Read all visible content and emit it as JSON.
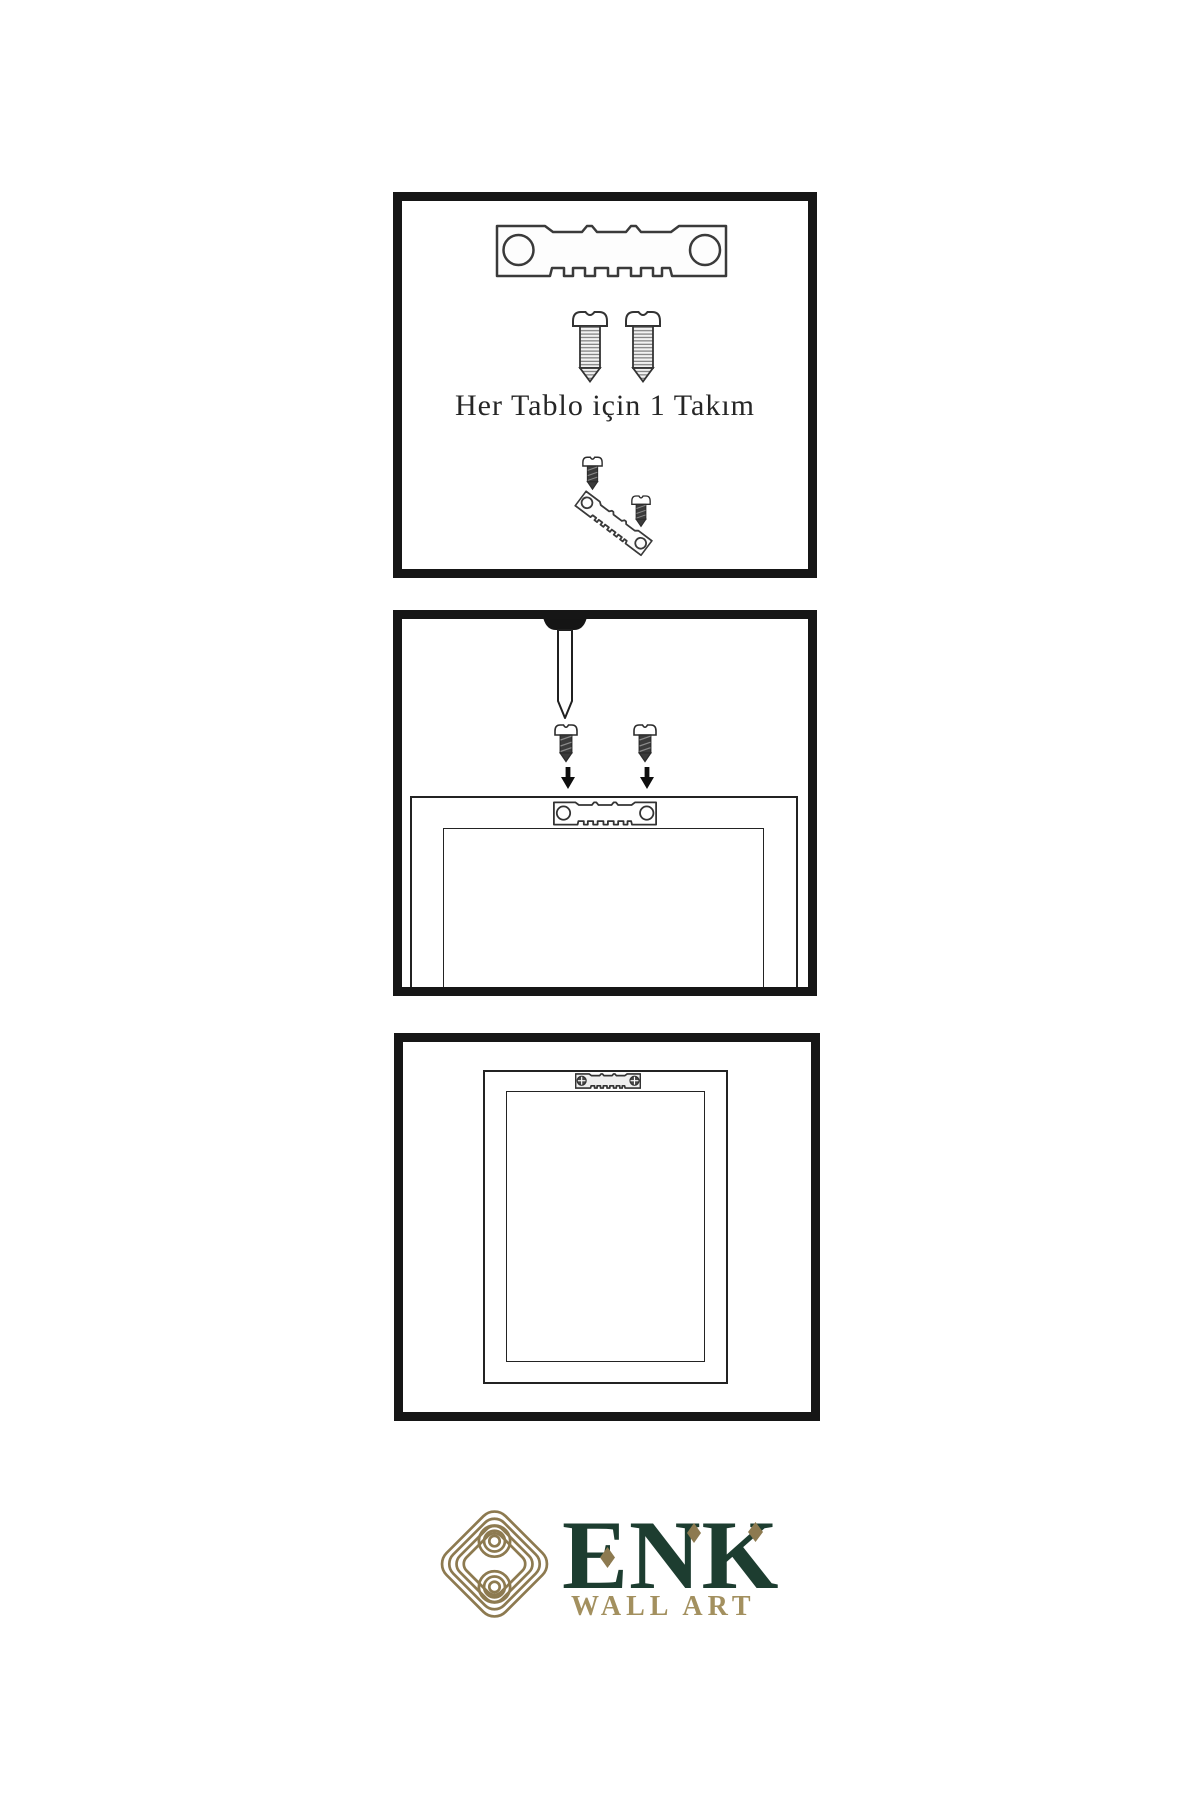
{
  "page": {
    "background": "#ffffff"
  },
  "panels": [
    {
      "id": "kit-contents",
      "label": "Her Tablo için 1 Takım",
      "contents": [
        "sawtooth-hanger",
        "screw",
        "screw",
        "screw-dark",
        "tilted-sawtooth-hanger",
        "screw-dark"
      ]
    },
    {
      "id": "attach-hanger-step",
      "contents": [
        "wall-nail",
        "screw-dark",
        "screw-dark",
        "down-arrow",
        "down-arrow",
        "frame-back-top-edge",
        "sawtooth-hanger"
      ]
    },
    {
      "id": "mounted-frame-step",
      "contents": [
        "frame-back",
        "sawtooth-hanger-screwed"
      ]
    }
  ],
  "brand": {
    "name": "ENK",
    "subtitle": "WALL ART",
    "logo_icon": "interlocked-knot",
    "colors": {
      "dark_green": "#1d3d30",
      "knot_gold": "#8d7a50",
      "subtitle_gold": "#a3905f"
    }
  },
  "style": {
    "panel_border_color": "#161616",
    "line_color": "#2b2b2b",
    "ink_color": "#262626"
  }
}
